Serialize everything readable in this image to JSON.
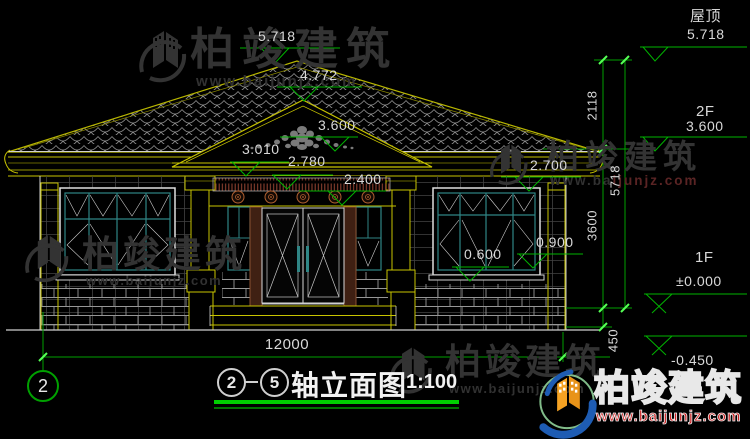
{
  "watermark": {
    "brand": "柏竣建筑",
    "url": "www.baijunjz.com",
    "url_left": "www.ba",
    "url_right": "ijunjz.com"
  },
  "marks": {
    "ridge": "5.718",
    "porch_ridge": "4.772",
    "eave": "3.600",
    "m3010": "3.010",
    "m2780": "2.780",
    "m2400": "2.400",
    "m2700": "2.700",
    "m0900": "0.900",
    "m0600": "0.600"
  },
  "levels": {
    "roof_label": "屋顶",
    "roof_value": "5.718",
    "f2_label": "2F",
    "f2_value": "3.600",
    "f1_label": "1F",
    "f1_value": "±0.000",
    "ground_value": "-0.450"
  },
  "vdims": {
    "d2118": "2118",
    "d5718": "5718",
    "d3600": "3600",
    "d450": "450"
  },
  "hdims": {
    "total": "12000"
  },
  "axis": {
    "bubble": "2"
  },
  "title": {
    "from": "2",
    "to": "5",
    "name": "轴立面图",
    "scale": "1:100"
  }
}
